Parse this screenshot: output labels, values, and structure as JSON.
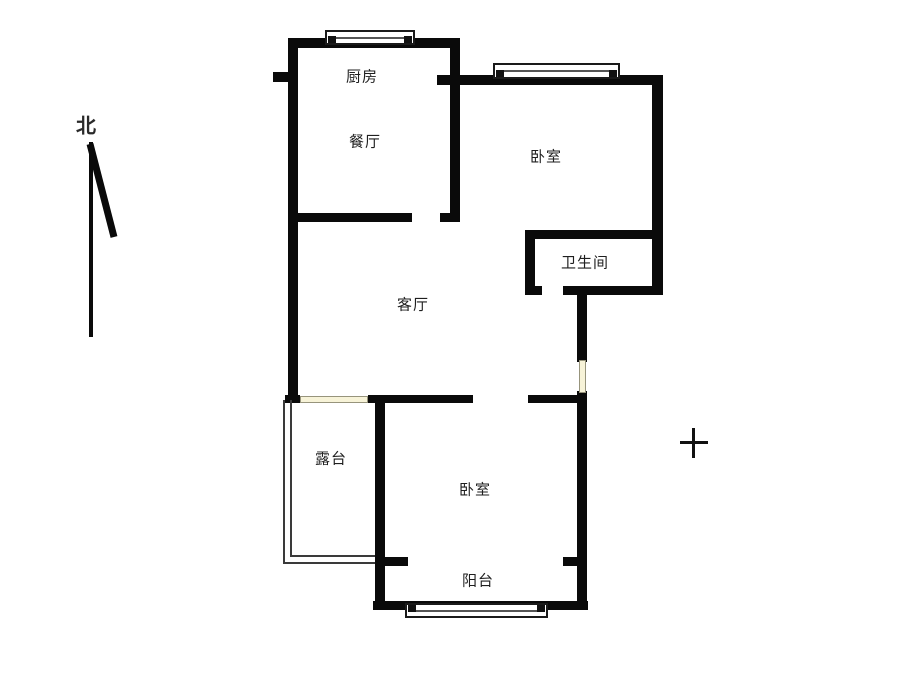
{
  "title": "apartment-floor-plan",
  "compass": {
    "north_label": "北"
  },
  "rooms": {
    "kitchen": {
      "label": "厨房"
    },
    "dining": {
      "label": "餐厅"
    },
    "bedroom_top": {
      "label": "卧室"
    },
    "bathroom": {
      "label": "卫生间"
    },
    "living": {
      "label": "客厅"
    },
    "terrace": {
      "label": "露台"
    },
    "bedroom_bottom": {
      "label": "卧室"
    },
    "balcony": {
      "label": "阳台"
    }
  },
  "marks": {
    "crosshair": "+"
  },
  "colors": {
    "wall": "#0a0a0a",
    "door_fill": "#f7f3d8",
    "door_border": "#97947c",
    "background": "#ffffff",
    "text": "#1f1f1f"
  }
}
